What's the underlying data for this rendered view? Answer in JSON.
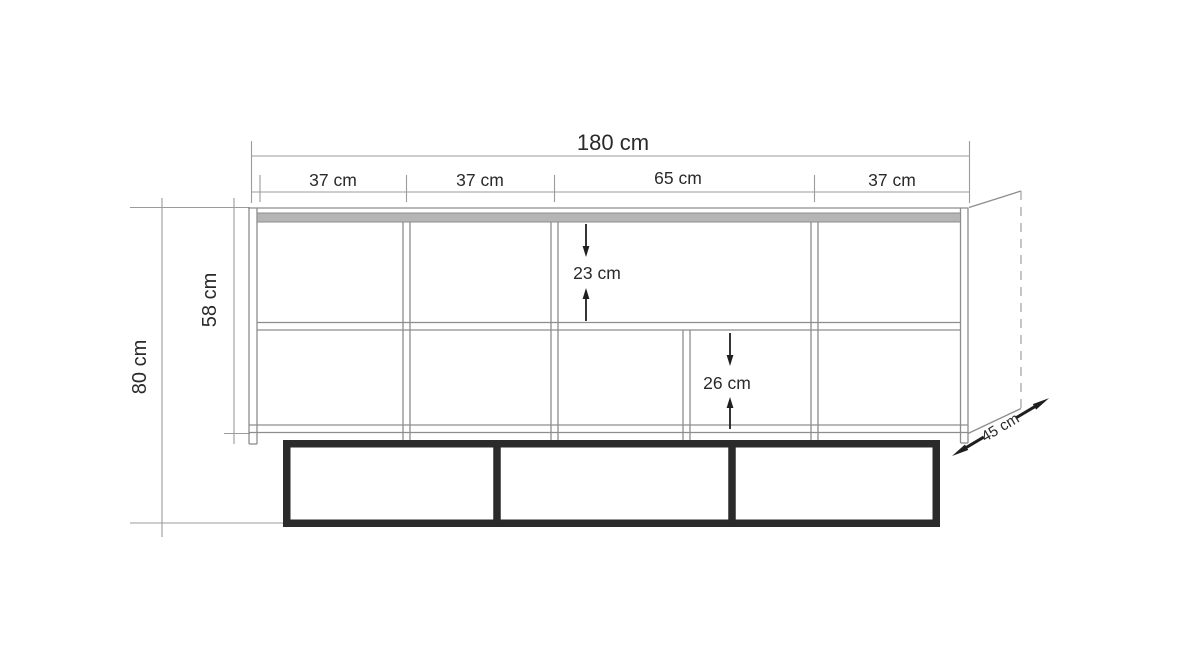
{
  "colors": {
    "background": "#ffffff",
    "line": "#8d8d8d",
    "dim_line": "#9b9b9b",
    "text": "#2a2a2a",
    "arrow": "#1f1f1f",
    "base": "#2b2b2b",
    "band_fill": "#b5b5b5",
    "dash": "#a8a8a8"
  },
  "dimensions": {
    "total_width": "180 cm",
    "sections": [
      {
        "label": "37 cm"
      },
      {
        "label": "37 cm"
      },
      {
        "label": "65 cm"
      },
      {
        "label": "37 cm"
      }
    ],
    "total_height": "80 cm",
    "body_height": "58 cm",
    "upper_compartment": "23 cm",
    "lower_compartment": "26 cm",
    "depth": "45 cm"
  }
}
